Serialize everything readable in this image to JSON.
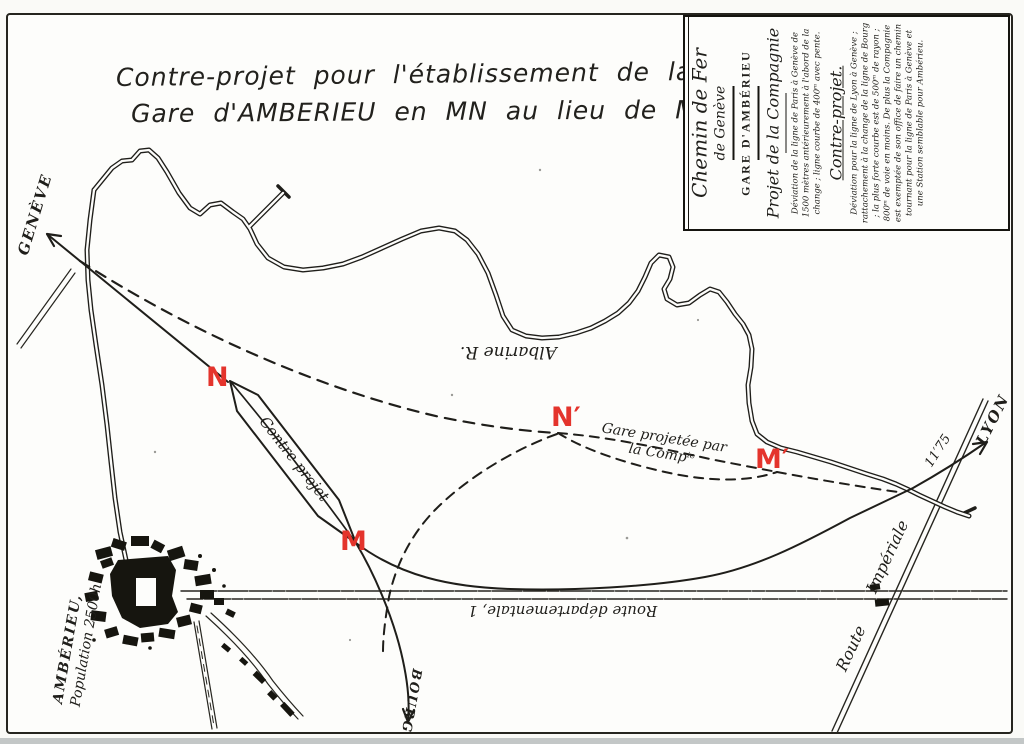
{
  "document": {
    "title_line1": "Contre-projet pour l'établissement de la",
    "title_line2": "Gare d'AMBERIEU en MN au lieu de M′N′."
  },
  "legend": {
    "header_line1": "Chemin de Fer",
    "header_line2": "de Genève",
    "station": "GARE D'AMBÉRIEU",
    "section1_title": "Projet de la Compagnie",
    "section1_text": "Déviation de la ligne de Paris à Genève de 1500 mètres antérieurement à l'abord de la change ; ligne courbe de 400ᵐ avec pente.",
    "section2_title": "Contre-projet.",
    "section2_text": "Déviation pour la ligne de Lyon à Genève ; rattachement à la change de la ligne de Bourg ; la plus forte courbe est de 500ᵐ de rayon ; 800ᵐ de voie en moins. De plus la Compagnie est exemptée de son office de faire un chemin tournant pour la ligne de Paris à Genève et une Station semblable pour Ambérieu."
  },
  "map_labels": {
    "geneve": "GENÈVE",
    "lyon": "LYON",
    "bourg": "BOURG",
    "town_name": "AMBÉRIEU,",
    "town_population": "Population 2500h",
    "river": "Albarine R.",
    "route_departementale": "Route départementale, 1",
    "route_word": "Route",
    "imperiale_word": "Impériale",
    "pk_marker": "11′75",
    "counter_station": "Contre-projet",
    "company_station_line1": "Gare projetée par",
    "company_station_line2": "la Compⁱᵉ",
    "point_n": "N",
    "point_m": "M",
    "point_n_prime": "N′",
    "point_m_prime": "M′"
  },
  "colors": {
    "ink": "#1f1e1a",
    "red": "#e4342c",
    "paper": "#fdfdfb"
  }
}
